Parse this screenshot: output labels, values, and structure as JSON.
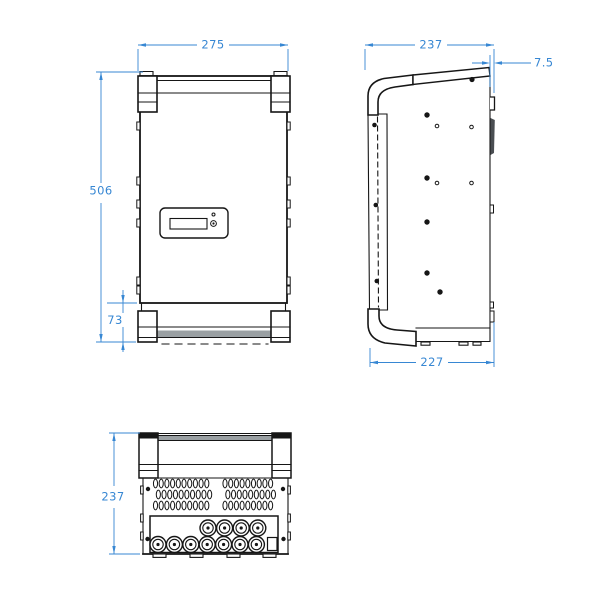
{
  "views": {
    "front": {
      "dims": {
        "width": "275",
        "height": "506",
        "bracket": "73"
      }
    },
    "side": {
      "dims": {
        "top_depth": "237",
        "rear_lip": "7.5",
        "bottom_depth": "227"
      }
    },
    "bottom": {
      "dims": {
        "depth": "237"
      },
      "connectors": {
        "top_row": 4,
        "bottom_row": 7
      }
    }
  },
  "colors": {
    "dimension_blue": "#3787d3",
    "line_ink": "#161616",
    "shade_gray": "#9aa0a3"
  }
}
